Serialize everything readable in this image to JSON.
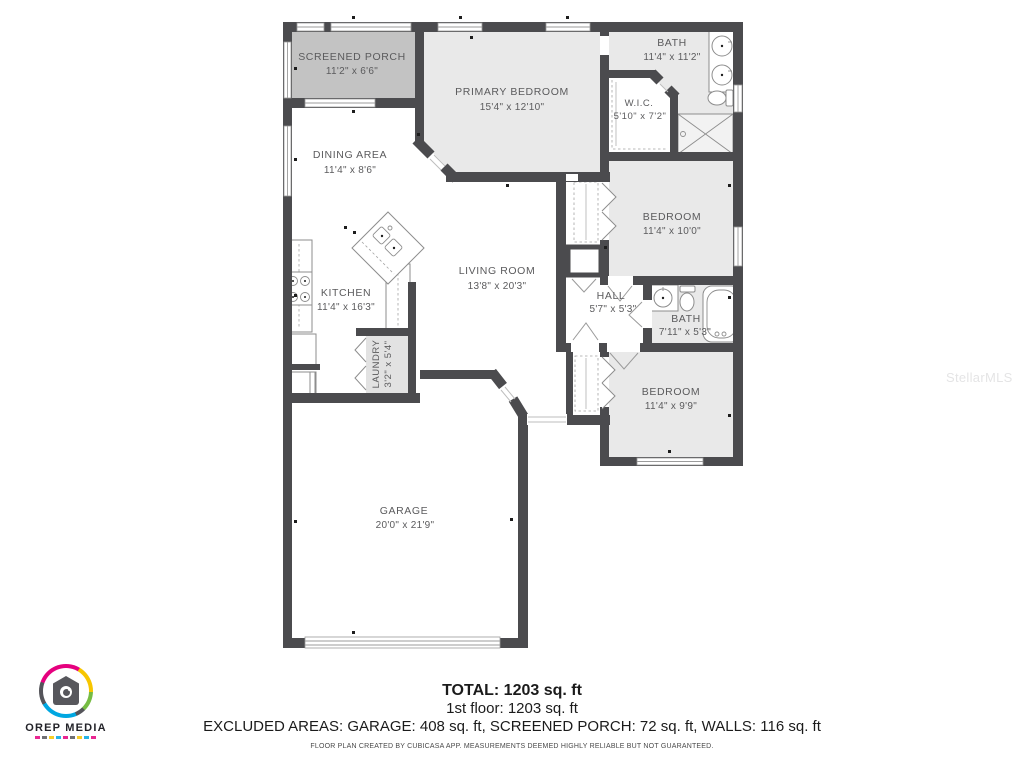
{
  "colors": {
    "wall": "#4b4b4e",
    "room": "#e9e9e9",
    "porch": "#c3c3c3",
    "laundry": "#e2e2e2",
    "label": "#5b5b5d",
    "logo-pink": "#e5007e",
    "logo-yellow": "#f7c600",
    "logo-green": "#76bc43",
    "logo-blue": "#00a7e1"
  },
  "watermark": {
    "text": "StellarMLS"
  },
  "rooms": {
    "screened_porch": {
      "name": "SCREENED PORCH",
      "dims": "11'2\" x 6'6\""
    },
    "primary_bedroom": {
      "name": "PRIMARY BEDROOM",
      "dims": "15'4\" x 12'10\""
    },
    "bath1": {
      "name": "BATH",
      "dims": "11'4\" x 11'2\""
    },
    "wic": {
      "name": "W.I.C.",
      "dims": "5'10\" x 7'2\""
    },
    "dining": {
      "name": "DINING AREA",
      "dims": "11'4\" x 8'6\""
    },
    "bedroom1": {
      "name": "BEDROOM",
      "dims": "11'4\" x 10'0\""
    },
    "kitchen": {
      "name": "KITCHEN",
      "dims": "11'4\" x 16'3\""
    },
    "living": {
      "name": "LIVING ROOM",
      "dims": "13'8\" x 20'3\""
    },
    "hall": {
      "name": "HALL",
      "dims": "5'7\" x 5'3\""
    },
    "bath2": {
      "name": "BATH",
      "dims": "7'11\" x 5'3\""
    },
    "laundry": {
      "name": "LAUNDRY",
      "dims": "3'2\" x 5'4\""
    },
    "bedroom2": {
      "name": "BEDROOM",
      "dims": "11'4\" x 9'9\""
    },
    "garage": {
      "name": "GARAGE",
      "dims": "20'0\" x 21'9\""
    }
  },
  "summary": {
    "total": "TOTAL: 1203 sq. ft",
    "first_floor": "1st floor: 1203 sq. ft",
    "excluded": "EXCLUDED AREAS: GARAGE: 408 sq. ft, SCREENED PORCH: 72 sq. ft, WALLS: 116 sq. ft",
    "disclaimer": "FLOOR PLAN CREATED BY CUBICASA APP. MEASUREMENTS DEEMED HIGHLY RELIABLE BUT NOT GUARANTEED."
  },
  "logo": {
    "brand": "OREP MEDIA"
  }
}
